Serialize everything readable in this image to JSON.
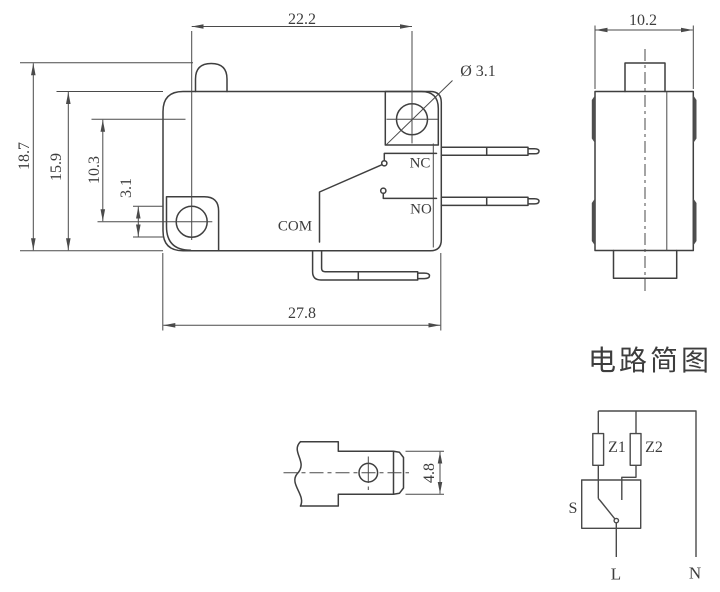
{
  "front": {
    "dim_hole_spacing": "22.2",
    "dim_overall_height": "18.7",
    "dim_body_height": "15.9",
    "dim_hole_offset": "10.3",
    "dim_hole_dia_left": "3.1",
    "dim_body_width": "27.8",
    "dim_hole_dia": "Ø 3.1",
    "terminal_nc": "NC",
    "terminal_no": "NO",
    "terminal_com": "COM"
  },
  "side": {
    "dim_width": "10.2"
  },
  "terminal_detail": {
    "dim_blade_width": "4.8"
  },
  "circuit": {
    "title": "电路简图",
    "impedance_1": "Z1",
    "impedance_2": "Z2",
    "switch": "S",
    "line": "L",
    "neutral": "N"
  },
  "colors": {
    "part_line": "#3f3f3f",
    "dim_line": "#4a4a4a",
    "text": "#3d3d3d"
  }
}
